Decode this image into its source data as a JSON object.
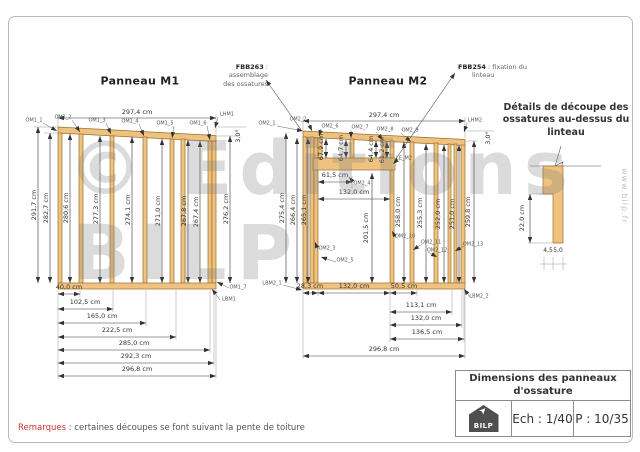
{
  "watermark": {
    "line1": "© Editions",
    "line2": "BILP",
    "website": "www.bilp.fr"
  },
  "panel_m1": {
    "title": "Panneau M1",
    "top_width": "297,4 cm",
    "roof_angle": "3,0°",
    "top_stud_labels": [
      "OM1_1",
      "OM1_2",
      "OM1_3",
      "OM1_4",
      "OM1_5",
      "OM1_6"
    ],
    "top_plate_label": "LHM1",
    "right_stud_label": "OM1_7",
    "bottom_plate_label": "LBM1",
    "stud_heights": [
      "291,7 cm",
      "282,7 cm",
      "280,6 cm",
      "277,3 cm",
      "274,1 cm",
      "271,0 cm",
      "267,8 cm",
      "267,4 cm",
      "276,2 cm"
    ],
    "bottom_dims": [
      "40,0 cm",
      "102,5 cm",
      "165,0 cm",
      "222,5 cm",
      "285,0 cm",
      "292,3 cm",
      "296,8 cm"
    ]
  },
  "panel_m2": {
    "title": "Panneau M2",
    "top_width": "297,4 cm",
    "roof_angle": "3,0°",
    "top_stud_labels": [
      "OM2_1",
      "OM2_2",
      "OM2_6",
      "OM2_7",
      "OM2_8",
      "OM2_9"
    ],
    "top_plate_label": "LHM2",
    "cripple_heights": [
      "67,9 cm",
      "64,7 cm",
      "64,4 cm",
      "61,2 cm"
    ],
    "lintel_label": "LE_M2",
    "lintel_offset": "61,5 cm",
    "opening_width": "132,0 cm",
    "opening_height": "201,5 cm",
    "sill_label": "OM2_4",
    "left_stud_heights": [
      "275,4 cm",
      "266,4 cm",
      "265,1 cm"
    ],
    "right_stud_heights": [
      "258,0 cm",
      "255,3 cm",
      "252,0 cm",
      "251,0 cm",
      "259,8 cm"
    ],
    "mid_stud_labels": [
      "OM2_3",
      "OM2_5",
      "OM2_10",
      "OM2_11",
      "OM2_12",
      "OM2_13"
    ],
    "bottom_plate_left_label": "LBM2_1",
    "bottom_plate_right_label": "LBM2_2",
    "bottom_row1_dims": [
      "28,3 cm",
      "132,0 cm",
      "50,5 cm"
    ],
    "bottom_dims": [
      "113,1 cm",
      "132,0 cm",
      "136,5 cm",
      "296,8 cm"
    ]
  },
  "callouts": {
    "fbb263_code": "FBB263",
    "fbb263_line1": ": assemblage",
    "fbb263_line2": "des ossatures",
    "fbb254_code": "FBB254",
    "fbb254_line1": ": fixation du",
    "fbb254_line2": "linteau"
  },
  "detail": {
    "title": "Détails de découpe des ossatures au-dessus du linteau",
    "cut_height": "22,0 cm",
    "width_left": "4,5",
    "width_right": "5,0"
  },
  "title_block": {
    "title_line1": "Dimensions des panneaux",
    "title_line2": "d'ossature",
    "logo_text": "BILP",
    "scale": "Ech : 1/40",
    "page": "P : 10/35"
  },
  "remark": {
    "label": "Remarques",
    "text": ": certaines découpes se font suivant la pente de toiture"
  },
  "colors": {
    "wood": "#efc37f",
    "wood_edge": "#9a6f30",
    "dim_line": "#333333",
    "accent_red": "#cc3333"
  }
}
